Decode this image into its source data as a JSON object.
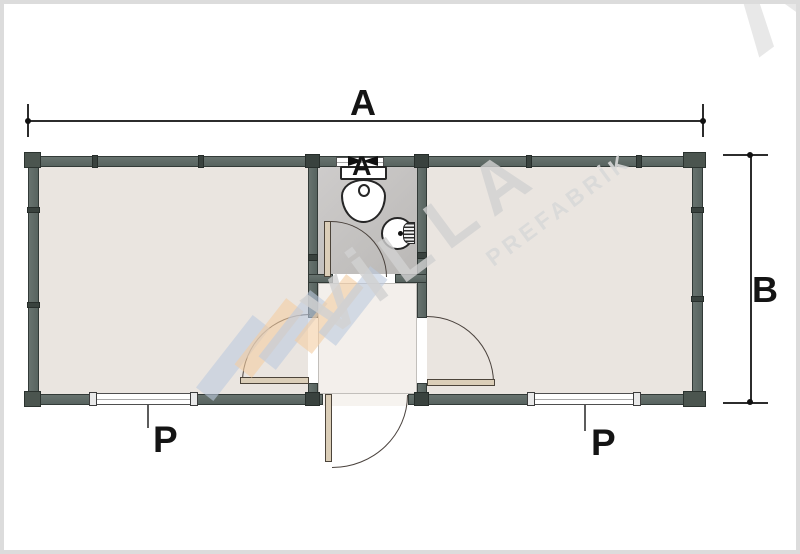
{
  "page": {
    "background": "#ffffff",
    "frame_color": "#dcdcdc"
  },
  "plan": {
    "wall_color": "#5e6a66",
    "wall_edge_color": "#323a37",
    "room_floor_color": "#eae5e0",
    "bathroom_floor_color": "#c6c4c2",
    "hall_floor_color": "#f3efeb",
    "door_leaf_color": "#dbceb8"
  },
  "dimensions": {
    "width_label": "A",
    "height_label": "B"
  },
  "window_labels": {
    "left": "P",
    "right": "P",
    "bathroom_marker": "A"
  },
  "watermark": {
    "brand": "VİLLA",
    "subtitle": "PREFABRİK",
    "corner_letter": "Λ",
    "text_color": "#d2d2d2",
    "logo_blue": "#bccadd",
    "logo_orange": "#f3cda2"
  }
}
